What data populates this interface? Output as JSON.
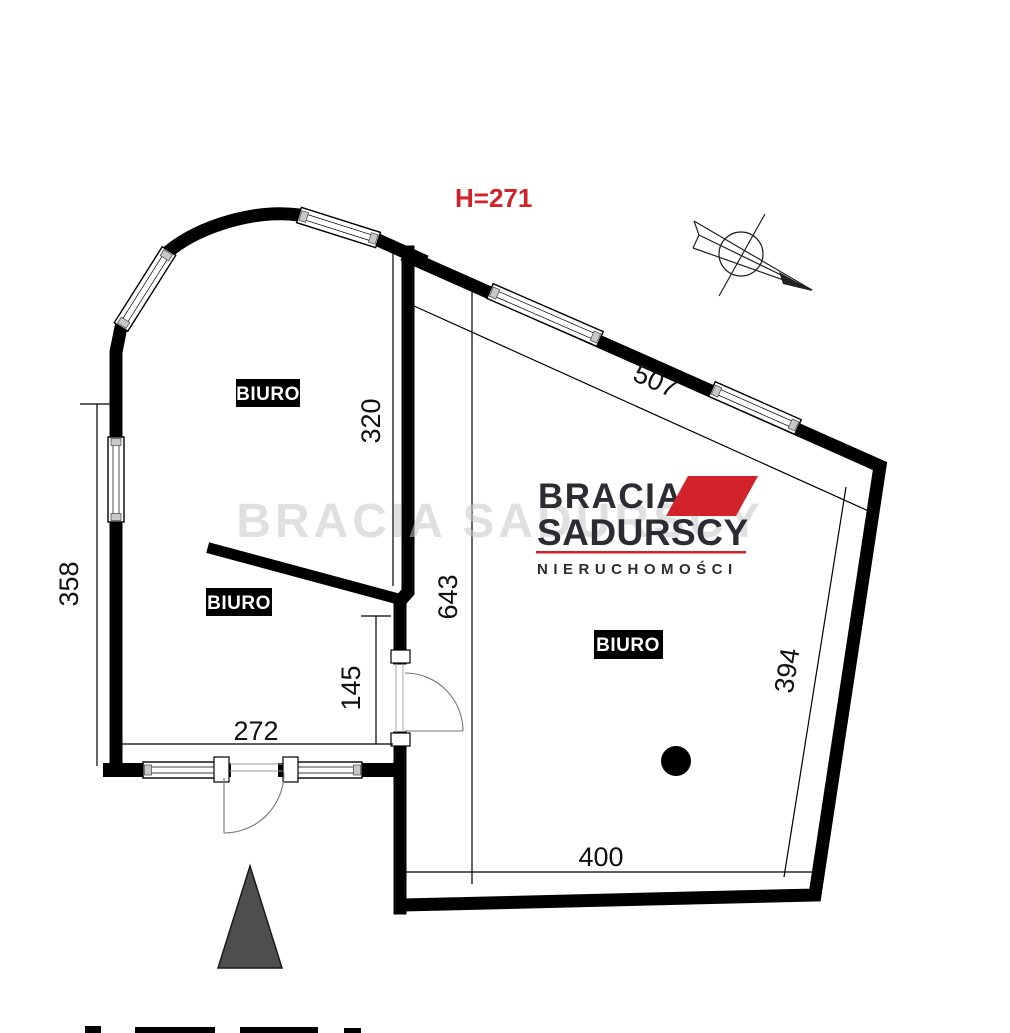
{
  "plan": {
    "height_label": "H=271",
    "rooms": [
      {
        "label": "BIURO"
      },
      {
        "label": "BIURO"
      },
      {
        "label": "BIURO"
      }
    ],
    "dimensions": {
      "d320": "320",
      "d358": "358",
      "d272": "272",
      "d145": "145",
      "d643": "643",
      "d507": "507",
      "d394": "394",
      "d400": "400"
    }
  },
  "logo": {
    "line1": "BRACIA",
    "line2": "SADURSCY",
    "tagline": "NIERUCHOMOŚCI",
    "watermark": "BRACIA SADURSCY"
  },
  "colors": {
    "red": "#d2232a",
    "logo_dark": "#2e2c33",
    "wall": "#000000",
    "triangle": "#4f4e4e",
    "watermark_gray": "#c7c7c7"
  }
}
